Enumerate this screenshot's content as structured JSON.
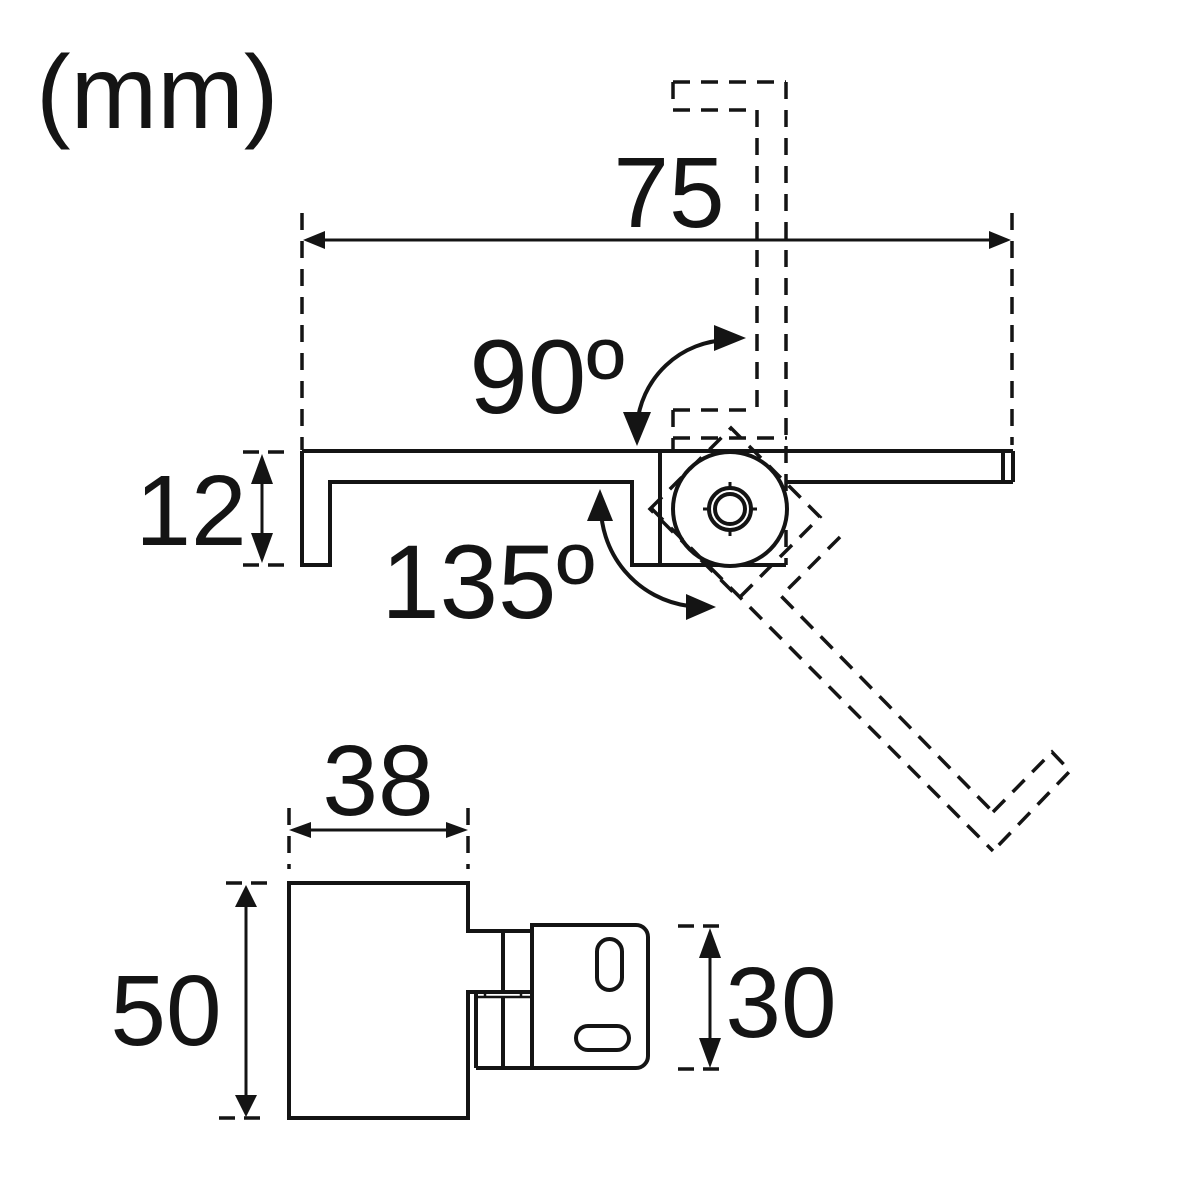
{
  "units_label": "(mm)",
  "colors": {
    "line": "#141414",
    "background": "#ffffff"
  },
  "side_view": {
    "width_dim": "75",
    "channel_height_dim": "12",
    "open_up_angle": "90º",
    "open_down_angle": "135º"
  },
  "front_view": {
    "body_width_dim": "38",
    "body_height_dim": "50",
    "plate_height_dim": "30"
  }
}
